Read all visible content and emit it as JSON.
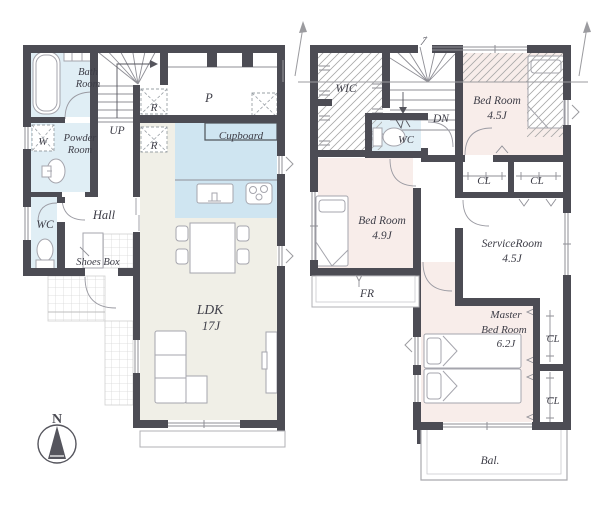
{
  "colors": {
    "wall": "#4c4c54",
    "water_blue": "#e0eef5",
    "kitchen_blue": "#cfe5f1",
    "floor_beige": "#f0efe7",
    "room_pink": "#f8edea",
    "line_gray": "#8f8f96",
    "text": "#3d3d47"
  },
  "floor1": {
    "bath_line1": "Bath",
    "bath_line2": "Room",
    "up": "UP",
    "washer": "W",
    "powder_line1": "Powder",
    "powder_line2": "Room",
    "wc": "WC",
    "hall": "Hall",
    "shoes_box": "Shoes Box",
    "storage_r1": "R",
    "storage_r2": "R",
    "pantry": "P",
    "cupboard": "Cupboard",
    "ldk_line1": "LDK",
    "ldk_line2": "17J"
  },
  "floor2": {
    "wic": "WIC",
    "dn": "DN",
    "wc": "WC",
    "bedroom1_line1": "Bed Room",
    "bedroom1_line2": "4.5J",
    "closet1": "CL",
    "closet2": "CL",
    "bedroom2_line1": "Bed Room",
    "bedroom2_line2": "4.9J",
    "service_line1": "ServiceRoom",
    "service_line2": "4.5J",
    "fr": "FR",
    "master_line1": "Master",
    "master_line2": "Bed Room",
    "master_line3": "6.2J",
    "closet3": "CL",
    "closet4": "CL",
    "balcony": "Bal."
  },
  "compass": {
    "north": "N"
  }
}
